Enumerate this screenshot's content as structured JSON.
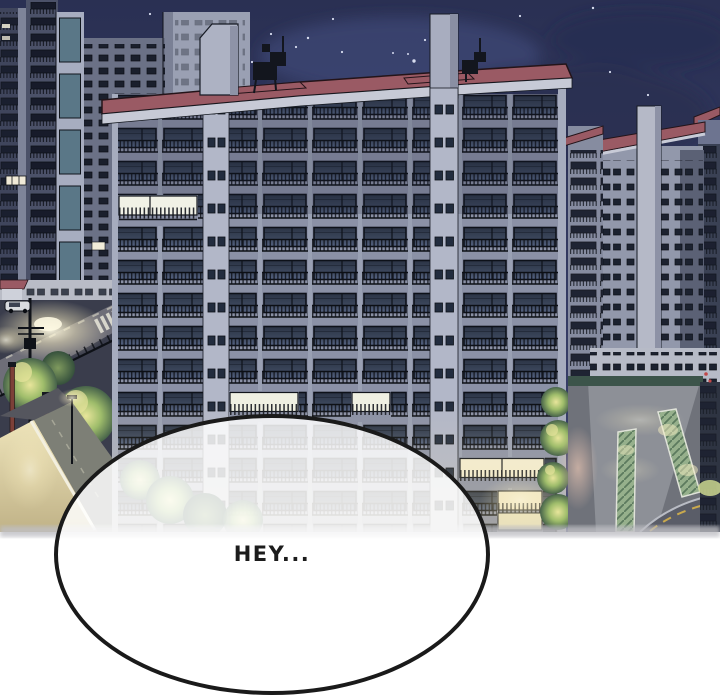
{
  "panel": {
    "type": "webtoon-panel",
    "alt": "Night scene of a high-rise apartment complex with lit windows, street lamps, trees and roads; a large white speech bubble at the bottom",
    "width": 720,
    "height": 700
  },
  "bubble": {
    "text": "HEY..."
  },
  "palette": {
    "page_bg": "#ffffff",
    "ink": "#1c1c1c",
    "bubble_border": "#1a1a1a",
    "bubble_overlay": "rgba(255,255,255,0.84)",
    "sky_top": "#2a3053",
    "sky_bottom": "#3b426e",
    "cloud_dark": "#262c4e",
    "facade": "#858ba0",
    "facade_light": "#b6bac8",
    "window_glass": "#3a455a",
    "window_lit": "#f0f1e6",
    "roof_red": "#9a5a64",
    "tree_lit": "#e6e39b",
    "tree_green": "#9fbd6b",
    "street_glow": "#fff3c5",
    "road_lit": "#d6cba0",
    "hedge": "#96b08c",
    "outline": "#14181f",
    "panel_edge": "#bfbfc4"
  }
}
